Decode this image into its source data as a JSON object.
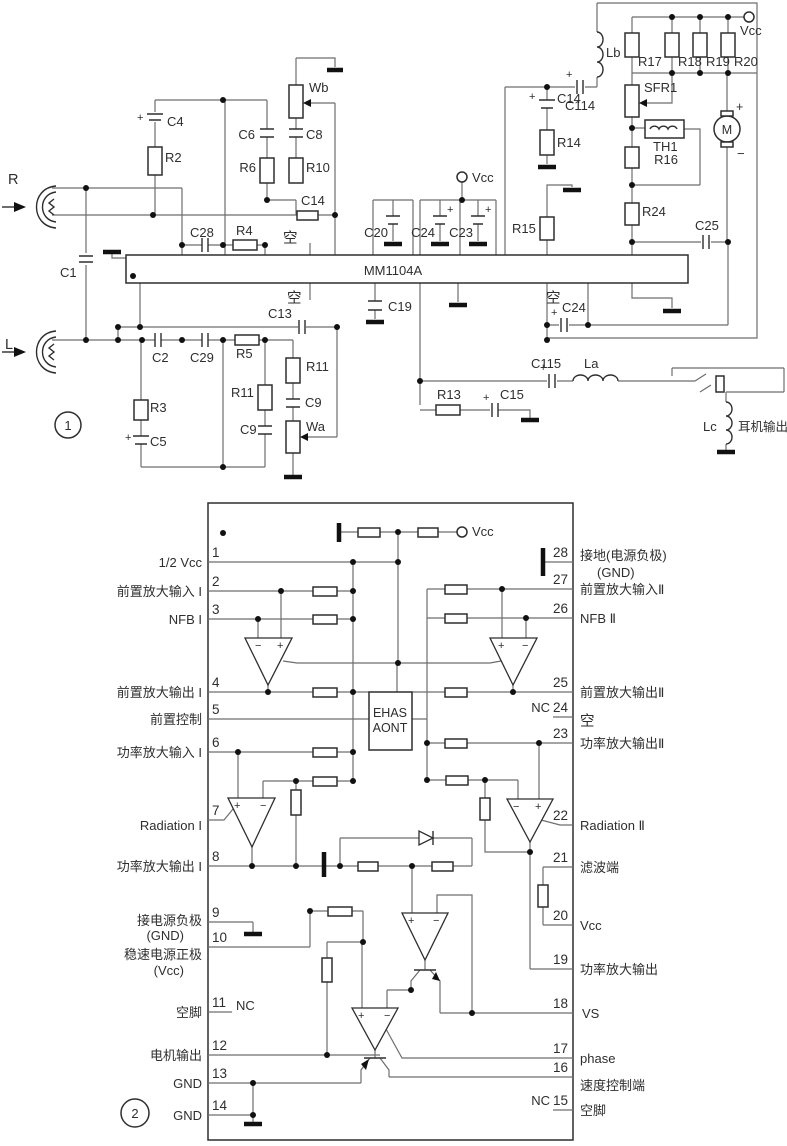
{
  "fig1": {
    "badge": "1",
    "ic": "MM1104A",
    "vcc": "Vcc",
    "empty": "空",
    "plus": "+",
    "minus": "−",
    "inputs": {
      "r": "R",
      "l": "L"
    },
    "headphone_out": "耳机输出",
    "labels": {
      "c1": "C1",
      "c4": "C4",
      "r2": "R2",
      "c28": "C28",
      "r4": "R4",
      "wb": "Wb",
      "c6": "C6",
      "c8": "C8",
      "r6": "R6",
      "r10": "R10",
      "c14_top": "C14",
      "c13": "C13",
      "c2": "C2",
      "c29": "C29",
      "r5": "R5",
      "r11_a": "R11",
      "c9_a": "C9",
      "wa": "Wa",
      "r11_b": "R11",
      "c9_b": "C9",
      "r3": "R3",
      "c5": "C5",
      "c19": "C19",
      "c20": "C20",
      "c24_mid": "C24",
      "c23": "C23",
      "r15": "R15",
      "lb": "Lb",
      "c114": "C114",
      "c14_right": "C14",
      "r14": "R14",
      "r17": "R17",
      "r18": "R18",
      "r19": "R19",
      "r20": "R20",
      "sfr1": "SFR1",
      "th1": "TH1",
      "r16": "R16",
      "motor": "M",
      "r24": "R24",
      "c25": "C25",
      "c24_right": "C24",
      "c115": "C115",
      "la": "La",
      "r13": "R13",
      "c15": "C15",
      "lc": "Lc"
    }
  },
  "fig2": {
    "badge": "2",
    "vcc": "Vcc",
    "block": {
      "line1": "EHAS",
      "line2": "AONT"
    },
    "pins_left": [
      {
        "n": "1",
        "label": "1/2 Vcc"
      },
      {
        "n": "2",
        "label": "前置放大输入 I"
      },
      {
        "n": "3",
        "label": "NFB I"
      },
      {
        "n": "4",
        "label": "前置放大输出 I"
      },
      {
        "n": "5",
        "label": "前置控制"
      },
      {
        "n": "6",
        "label": "功率放大输入 I"
      },
      {
        "n": "7",
        "label": "Radiation I"
      },
      {
        "n": "8",
        "label": "功率放大输出 I"
      },
      {
        "n": "9",
        "label": "接电源负极",
        "sub": "(GND)"
      },
      {
        "n": "10",
        "label": "稳速电源正极",
        "sub": "(Vcc)"
      },
      {
        "n": "11",
        "label": "空脚",
        "nc": "NC"
      },
      {
        "n": "12",
        "label": "电机输出"
      },
      {
        "n": "13",
        "label": "GND"
      },
      {
        "n": "14",
        "label": "GND"
      }
    ],
    "pins_right": [
      {
        "n": "28",
        "label": "接地(电源负极)",
        "sub": "(GND)"
      },
      {
        "n": "27",
        "label": "前置放大输入Ⅱ"
      },
      {
        "n": "26",
        "label": "NFB Ⅱ"
      },
      {
        "n": "25",
        "label": "前置放大输出Ⅱ"
      },
      {
        "n": "24",
        "label": "空",
        "nc": "NC"
      },
      {
        "n": "23",
        "label": "功率放大输出Ⅱ"
      },
      {
        "n": "22",
        "label": "Radiation Ⅱ"
      },
      {
        "n": "21",
        "label": "滤波端"
      },
      {
        "n": "20",
        "label": "Vcc"
      },
      {
        "n": "19",
        "label": "功率放大输出"
      },
      {
        "n": "18",
        "label": "VS"
      },
      {
        "n": "17",
        "label": "phase"
      },
      {
        "n": "16",
        "label": "速度控制端"
      },
      {
        "n": "15",
        "label": "空脚",
        "nc": "NC"
      }
    ]
  }
}
